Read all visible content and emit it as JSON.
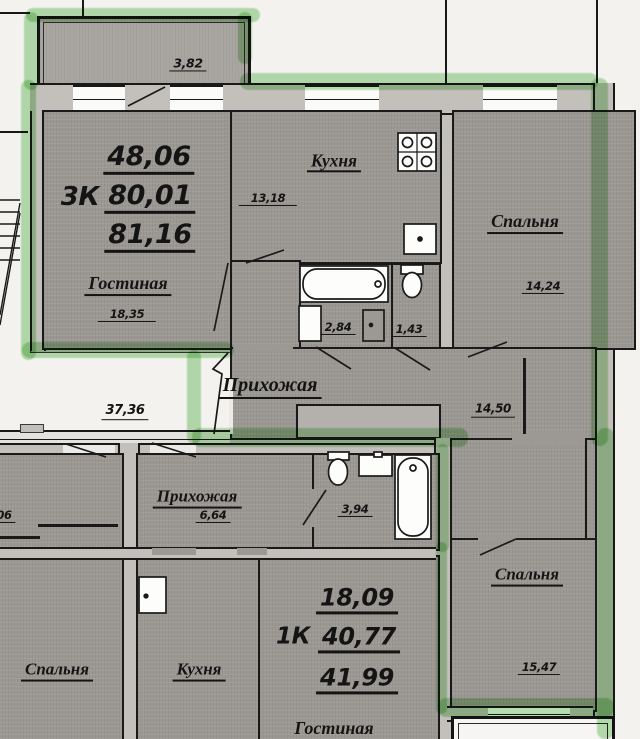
{
  "apartments": {
    "three_room": {
      "code": "3К",
      "areas": {
        "living": "48,06",
        "usable": "80,01",
        "total": "81,16"
      },
      "rooms": {
        "living": {
          "name": "Гостиная",
          "area": "18,35"
        },
        "kitchen": {
          "name": "Кухня",
          "area": "13,18"
        },
        "bedroom_top": {
          "name": "Спальня",
          "area": "14,24"
        },
        "bedroom_bottom": {
          "name": "Спальня",
          "area": "15,47"
        },
        "bathroom": {
          "area": "2,84"
        },
        "wc": {
          "area": "1,43"
        },
        "hallway": {
          "name": "Прихожая",
          "area": "14,50"
        },
        "balcony": {
          "area": "3,82"
        }
      }
    },
    "one_room": {
      "code": "1К",
      "areas": {
        "living": "18,09",
        "usable": "40,77",
        "total": "41,99"
      },
      "rooms": {
        "living": {
          "name": "Гостиная"
        },
        "hallway": {
          "name": "Прихожая",
          "area": "6,64"
        },
        "bathroom": {
          "area": "3,94"
        }
      }
    },
    "adjacent": {
      "bedroom": {
        "name": "Спальня"
      },
      "kitchen": {
        "name": "Кухня"
      },
      "partial_area": "06"
    }
  },
  "common_areas": {
    "stair_landing_area": "37,36"
  },
  "colors": {
    "highlighter": "#74c368",
    "room_fill": "#9c9994",
    "wall_fill": "#c3c0bb",
    "line": "#191919",
    "paper": "#f3f2ef"
  }
}
